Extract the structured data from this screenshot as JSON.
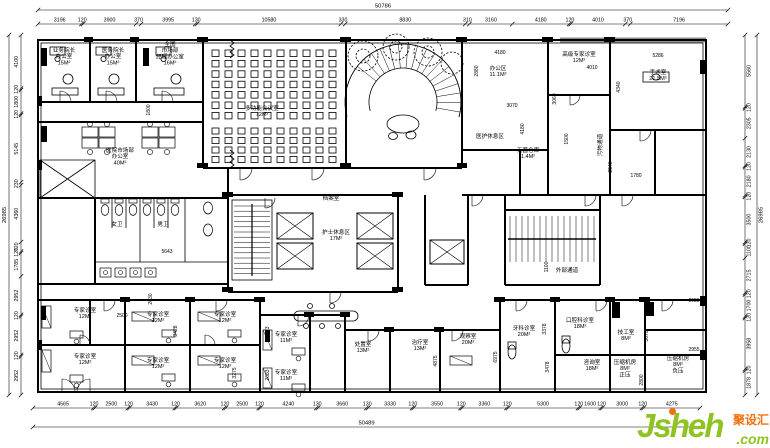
{
  "watermark": {
    "brand": "Jsheh",
    "tld": ".com",
    "badge": "聚设汇",
    "green": "#8fc31f",
    "orange": "#f3700e"
  },
  "dimensions": {
    "top": {
      "overall": "50786",
      "segments": [
        "3196",
        "120",
        "3900",
        "370",
        "3995",
        "130",
        "10580",
        "330",
        "8830",
        "310",
        "3160",
        "4180",
        "120",
        "4010",
        "370",
        "7196"
      ]
    },
    "bottom": {
      "overall": "50489",
      "segments": [
        "4565",
        "120",
        "2500",
        "120",
        "3430",
        "120",
        "3620",
        "120",
        "2500",
        "120",
        "4240",
        "130",
        "3660",
        "130",
        "3330",
        "120",
        "3550",
        "120",
        "3360",
        "120",
        "5300",
        "120",
        "1600",
        "120",
        "3000",
        "120",
        "4275"
      ]
    },
    "left": {
      "overall": "26985",
      "segments": [
        "4100",
        "120",
        "1800",
        "120",
        "5145",
        "230",
        "4360",
        "720",
        "120",
        "1785",
        "2952",
        "120",
        "2952",
        "120",
        "2952"
      ]
    },
    "right": {
      "overall": "26985",
      "segments": [
        "5560",
        "120",
        "2305",
        "2130",
        "120",
        "2180",
        "120",
        "3500",
        "120",
        "1100",
        "2715",
        "120",
        "1700",
        "120",
        "3958",
        "120",
        "1878"
      ]
    }
  },
  "conference_hall": {
    "columns": 10,
    "rows_front": 7,
    "rows_back": 4
  },
  "rooms": [
    {
      "lines": [
        "业务院长",
        "办公室",
        "15M²"
      ],
      "x": 64,
      "y": 52
    },
    {
      "lines": [
        "医务院长",
        "办公室",
        "15M²"
      ],
      "x": 113,
      "y": 52
    },
    {
      "lines": [
        "全国",
        "市场部",
        "经理办公室",
        "16M²"
      ],
      "x": 170,
      "y": 46
    },
    {
      "lines": [
        "医院市场部",
        "办公室",
        "40M²"
      ],
      "x": 120,
      "y": 152
    },
    {
      "lines": [
        "多功能会议室",
        "72M²"
      ],
      "x": 262,
      "y": 110
    },
    {
      "lines": [
        "档案室"
      ],
      "x": 331,
      "y": 200
    },
    {
      "lines": [
        "护士休息区",
        "17M²"
      ],
      "x": 336,
      "y": 234
    },
    {
      "lines": [
        "办公区",
        "11.1M²"
      ],
      "x": 498,
      "y": 70
    },
    {
      "lines": [
        "高级专家诊室",
        "12M²"
      ],
      "x": 579,
      "y": 56
    },
    {
      "lines": [
        "手术室",
        "21.5M²"
      ],
      "x": 658,
      "y": 74
    },
    {
      "lines": [
        "医护休息区"
      ],
      "x": 490,
      "y": 138
    },
    {
      "lines": [
        "无菌仓库",
        "1.4M²"
      ],
      "x": 528,
      "y": 152
    },
    {
      "lines": [
        "污物通道"
      ],
      "x": 602,
      "y": 145,
      "v": true
    },
    {
      "lines": [
        "外部通道"
      ],
      "x": 567,
      "y": 272
    },
    {
      "lines": [
        "女卫"
      ],
      "x": 117,
      "y": 226
    },
    {
      "lines": [
        "男卫"
      ],
      "x": 163,
      "y": 226
    },
    {
      "lines": [
        "专家诊室",
        "12M²"
      ],
      "x": 85,
      "y": 312
    },
    {
      "lines": [
        "专家诊室",
        "12M²"
      ],
      "x": 85,
      "y": 358
    },
    {
      "lines": [
        "专家诊室",
        "12M²"
      ],
      "x": 158,
      "y": 316
    },
    {
      "lines": [
        "专家诊室",
        "12M²"
      ],
      "x": 158,
      "y": 362
    },
    {
      "lines": [
        "专家诊室",
        "12M²"
      ],
      "x": 225,
      "y": 316
    },
    {
      "lines": [
        "专家诊室",
        "12M²"
      ],
      "x": 225,
      "y": 362
    },
    {
      "lines": [
        "专家诊室",
        "11M²"
      ],
      "x": 286,
      "y": 336
    },
    {
      "lines": [
        "专家诊室",
        "11M²"
      ],
      "x": 286,
      "y": 374
    },
    {
      "lines": [
        "处置室",
        "13M²"
      ],
      "x": 363,
      "y": 346
    },
    {
      "lines": [
        "治疗室",
        "13M²"
      ],
      "x": 420,
      "y": 344
    },
    {
      "lines": [
        "观察室",
        "20M²"
      ],
      "x": 468,
      "y": 338
    },
    {
      "lines": [
        "牙科诊室",
        "20M²"
      ],
      "x": 524,
      "y": 330
    },
    {
      "lines": [
        "口腔科诊室",
        "18M²"
      ],
      "x": 580,
      "y": 322
    },
    {
      "lines": [
        "咨询室",
        "18M²"
      ],
      "x": 592,
      "y": 364
    },
    {
      "lines": [
        "技工室",
        "8M²"
      ],
      "x": 626,
      "y": 334
    },
    {
      "lines": [
        "压缩机房",
        "8M²",
        "正压"
      ],
      "x": 625,
      "y": 364
    },
    {
      "lines": [
        "压缩机房",
        "8M²",
        "负压"
      ],
      "x": 678,
      "y": 360
    }
  ],
  "inline_dims": [
    {
      "t": "1800",
      "x": 150,
      "y": 110,
      "v": true
    },
    {
      "t": "5643",
      "x": 167,
      "y": 253
    },
    {
      "t": "2030",
      "x": 152,
      "y": 299,
      "v": true
    },
    {
      "t": "2500",
      "x": 122,
      "y": 317
    },
    {
      "t": "3428",
      "x": 177,
      "y": 331,
      "v": true
    },
    {
      "t": "3275",
      "x": 236,
      "y": 373,
      "v": true
    },
    {
      "t": "2673",
      "x": 269,
      "y": 332,
      "v": true
    },
    {
      "t": "2683",
      "x": 269,
      "y": 375,
      "v": true
    },
    {
      "t": "4875",
      "x": 437,
      "y": 361,
      "v": true
    },
    {
      "t": "6975",
      "x": 497,
      "y": 357,
      "v": true
    },
    {
      "t": "3378",
      "x": 546,
      "y": 329,
      "v": true
    },
    {
      "t": "3478",
      "x": 549,
      "y": 367,
      "v": true
    },
    {
      "t": "3070",
      "x": 648,
      "y": 336,
      "v": true
    },
    {
      "t": "2800",
      "x": 643,
      "y": 380,
      "v": true
    },
    {
      "t": "2955",
      "x": 694,
      "y": 302
    },
    {
      "t": "2955",
      "x": 694,
      "y": 351
    },
    {
      "t": "4180",
      "x": 500,
      "y": 54
    },
    {
      "t": "2880",
      "x": 478,
      "y": 71,
      "v": true
    },
    {
      "t": "3070",
      "x": 512,
      "y": 107
    },
    {
      "t": "4180",
      "x": 524,
      "y": 129,
      "v": true
    },
    {
      "t": "3060",
      "x": 556,
      "y": 99,
      "v": true
    },
    {
      "t": "4010",
      "x": 592,
      "y": 69
    },
    {
      "t": "1500",
      "x": 568,
      "y": 139,
      "v": true
    },
    {
      "t": "5286",
      "x": 658,
      "y": 57
    },
    {
      "t": "4340",
      "x": 620,
      "y": 87,
      "v": true
    },
    {
      "t": "1100",
      "x": 548,
      "y": 267,
      "v": true
    },
    {
      "t": "1780",
      "x": 636,
      "y": 177
    },
    {
      "t": "2540",
      "x": 612,
      "y": 167,
      "v": true
    }
  ]
}
